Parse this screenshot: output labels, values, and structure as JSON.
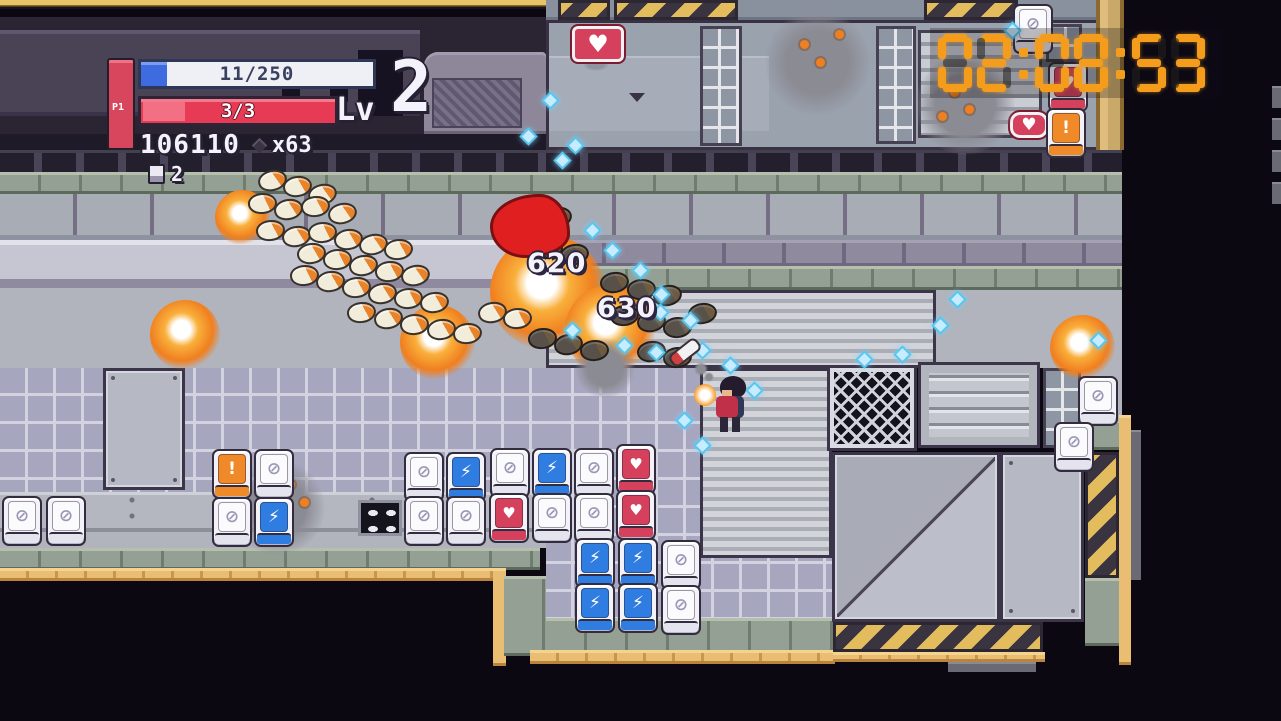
{
  "hud": {
    "player_label": "P1",
    "xp_bar": {
      "value": "11/250"
    },
    "hp_bar": {
      "value": "3/3"
    },
    "level_label": "Lv",
    "level_value": "2",
    "score": "106110",
    "multiplier": "x63",
    "pickup_count": "2"
  },
  "timer": {
    "value": "02:08:53",
    "digits": [
      "0",
      "2",
      ":",
      "0",
      "8",
      ":",
      "5",
      "3"
    ],
    "lit_color": "#f49c1c",
    "unlit_color": "rgba(35,32,30,0.55)"
  },
  "damage_numbers": [
    {
      "value": "620",
      "x": 527,
      "y": 248
    },
    {
      "value": "630",
      "x": 597,
      "y": 293
    }
  ],
  "signs": {
    "building_heart_emblem": "♥",
    "small_heart_sign": "♥"
  },
  "machine_icons": {
    "empty": "⊘",
    "energy": "⚡",
    "health": "♥",
    "alert": "!"
  },
  "entities": {
    "machines": [
      {
        "t": "empty",
        "x": 1013,
        "y": 4
      },
      {
        "t": "health",
        "x": 1048,
        "y": 62
      },
      {
        "t": "alert",
        "x": 1046,
        "y": 108
      },
      {
        "t": "alert",
        "x": 212,
        "y": 449
      },
      {
        "t": "empty",
        "x": 254,
        "y": 449
      },
      {
        "t": "empty",
        "x": 404,
        "y": 452
      },
      {
        "t": "energy",
        "x": 446,
        "y": 452
      },
      {
        "t": "empty",
        "x": 490,
        "y": 448
      },
      {
        "t": "energy",
        "x": 532,
        "y": 448
      },
      {
        "t": "empty",
        "x": 574,
        "y": 448
      },
      {
        "t": "health",
        "x": 616,
        "y": 444
      },
      {
        "t": "empty",
        "x": 2,
        "y": 496
      },
      {
        "t": "empty",
        "x": 46,
        "y": 496
      },
      {
        "t": "empty",
        "x": 212,
        "y": 497
      },
      {
        "t": "energy",
        "x": 254,
        "y": 497
      },
      {
        "t": "empty",
        "x": 404,
        "y": 496
      },
      {
        "t": "empty",
        "x": 446,
        "y": 496
      },
      {
        "t": "health",
        "x": 489,
        "y": 493
      },
      {
        "t": "empty",
        "x": 532,
        "y": 493
      },
      {
        "t": "empty",
        "x": 574,
        "y": 493
      },
      {
        "t": "health",
        "x": 616,
        "y": 490
      },
      {
        "t": "energy",
        "x": 575,
        "y": 538
      },
      {
        "t": "energy",
        "x": 618,
        "y": 538
      },
      {
        "t": "empty",
        "x": 661,
        "y": 540
      },
      {
        "t": "energy",
        "x": 575,
        "y": 583
      },
      {
        "t": "energy",
        "x": 618,
        "y": 583
      },
      {
        "t": "empty",
        "x": 661,
        "y": 585
      },
      {
        "t": "empty",
        "x": 1078,
        "y": 376
      },
      {
        "t": "empty",
        "x": 1054,
        "y": 422
      }
    ],
    "enemies": [
      {
        "x": 258,
        "y": 170,
        "r": -15
      },
      {
        "x": 283,
        "y": 176,
        "r": -10
      },
      {
        "x": 308,
        "y": 184,
        "r": -15
      },
      {
        "x": 248,
        "y": 193,
        "r": -5
      },
      {
        "x": 274,
        "y": 199,
        "r": -12
      },
      {
        "x": 301,
        "y": 196,
        "r": -8
      },
      {
        "x": 328,
        "y": 203,
        "r": -14
      },
      {
        "x": 256,
        "y": 220,
        "r": -8
      },
      {
        "x": 282,
        "y": 226,
        "r": -12
      },
      {
        "x": 308,
        "y": 222,
        "r": -6
      },
      {
        "x": 334,
        "y": 229,
        "r": -10
      },
      {
        "x": 359,
        "y": 234,
        "r": -14
      },
      {
        "x": 384,
        "y": 239,
        "r": -8
      },
      {
        "x": 297,
        "y": 243,
        "r": -10
      },
      {
        "x": 323,
        "y": 249,
        "r": -6
      },
      {
        "x": 349,
        "y": 255,
        "r": -12
      },
      {
        "x": 375,
        "y": 261,
        "r": -8
      },
      {
        "x": 401,
        "y": 265,
        "r": -14
      },
      {
        "x": 290,
        "y": 265,
        "r": -6
      },
      {
        "x": 316,
        "y": 271,
        "r": -10
      },
      {
        "x": 342,
        "y": 277,
        "r": -8
      },
      {
        "x": 368,
        "y": 283,
        "r": -12
      },
      {
        "x": 394,
        "y": 288,
        "r": -6
      },
      {
        "x": 420,
        "y": 292,
        "r": -10
      },
      {
        "x": 347,
        "y": 302,
        "r": -8
      },
      {
        "x": 374,
        "y": 308,
        "r": -12
      },
      {
        "x": 400,
        "y": 314,
        "r": -6
      },
      {
        "x": 427,
        "y": 319,
        "r": -10
      },
      {
        "x": 453,
        "y": 323,
        "r": -8
      },
      {
        "x": 478,
        "y": 302,
        "r": -12
      },
      {
        "x": 503,
        "y": 308,
        "r": -6
      },
      {
        "x": 516,
        "y": 200,
        "r": -8,
        "v": "dark"
      },
      {
        "x": 543,
        "y": 207,
        "r": -12,
        "v": "dark"
      },
      {
        "x": 508,
        "y": 232,
        "r": -10,
        "v": "dark"
      },
      {
        "x": 534,
        "y": 238,
        "r": -6,
        "v": "dark"
      },
      {
        "x": 560,
        "y": 244,
        "r": -12,
        "v": "dark"
      },
      {
        "x": 600,
        "y": 272,
        "r": -10,
        "v": "dark"
      },
      {
        "x": 627,
        "y": 279,
        "r": -6,
        "v": "dark"
      },
      {
        "x": 653,
        "y": 285,
        "r": -12,
        "v": "dark"
      },
      {
        "x": 610,
        "y": 305,
        "r": -8,
        "v": "dark"
      },
      {
        "x": 637,
        "y": 311,
        "r": -12,
        "v": "dark"
      },
      {
        "x": 663,
        "y": 317,
        "r": -6,
        "v": "dark"
      },
      {
        "x": 688,
        "y": 303,
        "r": -10,
        "v": "dark"
      },
      {
        "x": 528,
        "y": 328,
        "r": -8,
        "v": "dark"
      },
      {
        "x": 554,
        "y": 334,
        "r": -12,
        "v": "dark"
      },
      {
        "x": 580,
        "y": 340,
        "r": -6,
        "v": "dark"
      },
      {
        "x": 637,
        "y": 341,
        "r": -10,
        "v": "dark"
      },
      {
        "x": 663,
        "y": 347,
        "r": -8,
        "v": "dark"
      }
    ],
    "gems": [
      {
        "x": 546,
        "y": 96
      },
      {
        "x": 524,
        "y": 132
      },
      {
        "x": 558,
        "y": 156
      },
      {
        "x": 571,
        "y": 141
      },
      {
        "x": 588,
        "y": 226
      },
      {
        "x": 608,
        "y": 246
      },
      {
        "x": 636,
        "y": 266
      },
      {
        "x": 657,
        "y": 290
      },
      {
        "x": 686,
        "y": 316
      },
      {
        "x": 568,
        "y": 326
      },
      {
        "x": 620,
        "y": 341
      },
      {
        "x": 652,
        "y": 348
      },
      {
        "x": 698,
        "y": 346
      },
      {
        "x": 726,
        "y": 361
      },
      {
        "x": 750,
        "y": 386
      },
      {
        "x": 680,
        "y": 416
      },
      {
        "x": 698,
        "y": 441
      },
      {
        "x": 656,
        "y": 308
      },
      {
        "x": 936,
        "y": 321
      },
      {
        "x": 898,
        "y": 350
      },
      {
        "x": 953,
        "y": 295
      },
      {
        "x": 1008,
        "y": 26
      },
      {
        "x": 860,
        "y": 355
      },
      {
        "x": 1094,
        "y": 336
      }
    ],
    "explosions": [
      {
        "k": "fire",
        "x": 150,
        "y": 300,
        "s": 70
      },
      {
        "k": "fire",
        "x": 400,
        "y": 305,
        "s": 75
      },
      {
        "k": "fire",
        "x": 490,
        "y": 235,
        "s": 115
      },
      {
        "k": "fire",
        "x": 565,
        "y": 285,
        "s": 90
      },
      {
        "k": "fire",
        "x": 1050,
        "y": 315,
        "s": 65
      },
      {
        "k": "fire",
        "x": 215,
        "y": 190,
        "s": 55
      },
      {
        "k": "smoke",
        "x": 765,
        "y": 10,
        "s": 105
      },
      {
        "k": "smoke",
        "x": 915,
        "y": 55,
        "s": 100
      },
      {
        "k": "smoke",
        "x": 230,
        "y": 460,
        "s": 95
      },
      {
        "k": "smoke",
        "x": 575,
        "y": 338,
        "s": 60
      }
    ],
    "embers": [
      {
        "x": 800,
        "y": 40
      },
      {
        "x": 816,
        "y": 58
      },
      {
        "x": 835,
        "y": 30
      },
      {
        "x": 950,
        "y": 88
      },
      {
        "x": 965,
        "y": 105
      },
      {
        "x": 938,
        "y": 112
      },
      {
        "x": 286,
        "y": 480
      },
      {
        "x": 300,
        "y": 498
      },
      {
        "x": 272,
        "y": 505
      }
    ]
  }
}
